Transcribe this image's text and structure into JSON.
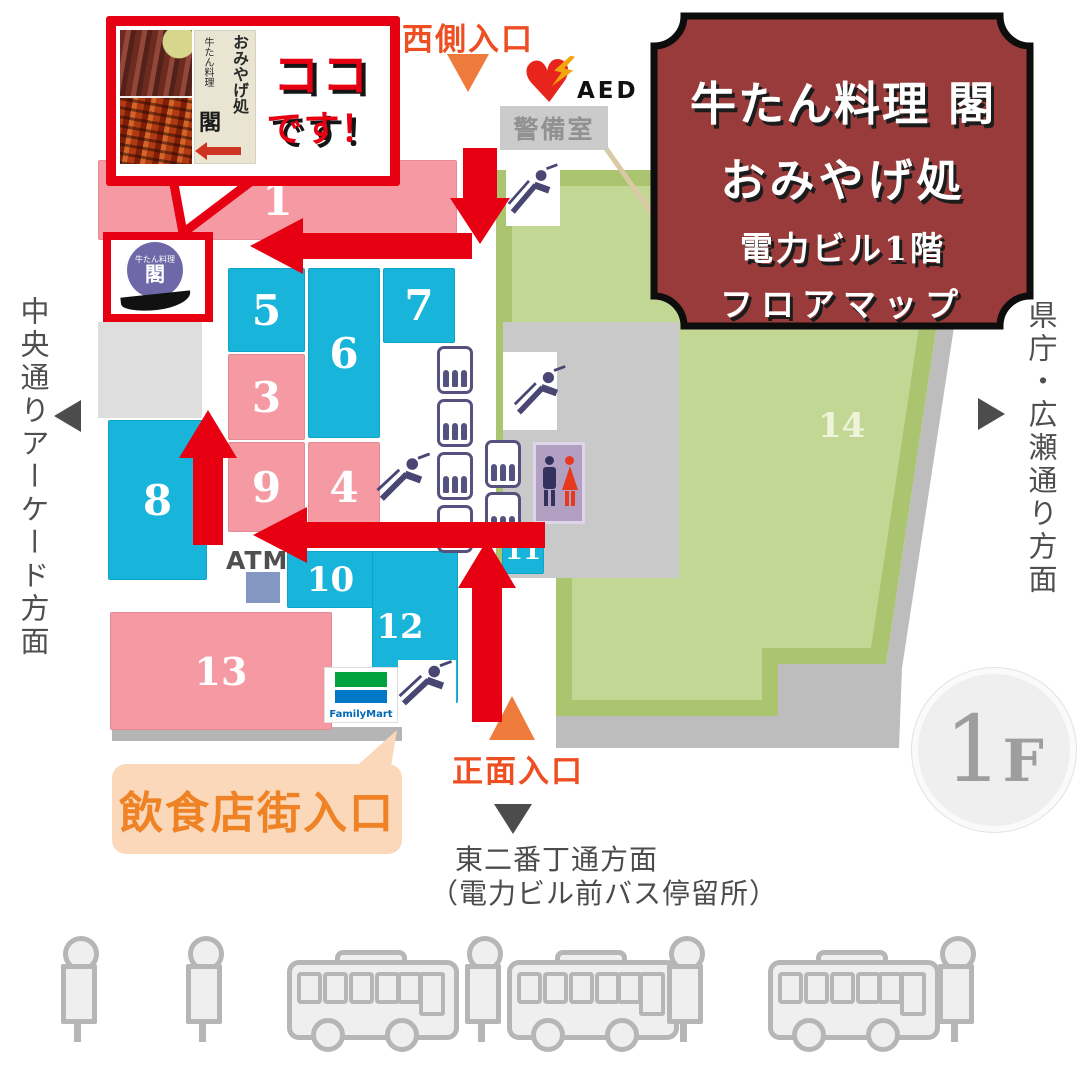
{
  "poster": {
    "title_plate": {
      "line1": "牛たん料理 閣",
      "line2": "おみやげ処",
      "line3": "電力ビル1階",
      "line4": "フロアマップ"
    },
    "callout": {
      "here_top": "ココ",
      "here_bottom": "です！",
      "sign_main": "おみやげ処",
      "sign_sub": "牛たん料理",
      "sign_kaku": "閣"
    },
    "marker": {
      "logo_sub": "牛たん料理",
      "logo_kaku": "閣"
    }
  },
  "map": {
    "entrances": {
      "west": "西側入口",
      "main": "正面入口",
      "dining": "飲食店街入口"
    },
    "directions": {
      "left_vertical": "中央通りアーケード方面",
      "right_vertical": "県庁・広瀬通り方面",
      "south_line1": "東二番丁通方面",
      "south_line2": "（電力ビル前バス停留所）"
    },
    "labels": {
      "security_room": "警備室",
      "aed": "AED",
      "atm": "ATM",
      "familymart": "FamilyMart",
      "floor_number": "1",
      "floor_letter": "F"
    },
    "block_numbers": [
      "1",
      "5",
      "6",
      "7",
      "3",
      "9",
      "4",
      "8",
      "10",
      "12",
      "13",
      "11",
      "14"
    ]
  },
  "colors": {
    "route_red": "#e60012",
    "block_pink": "#f59aa3",
    "block_cyan": "#18b4da",
    "area_green": "#abc46f",
    "plate_maroon": "#993b3b",
    "entrance_orange": "#ee4f22"
  }
}
